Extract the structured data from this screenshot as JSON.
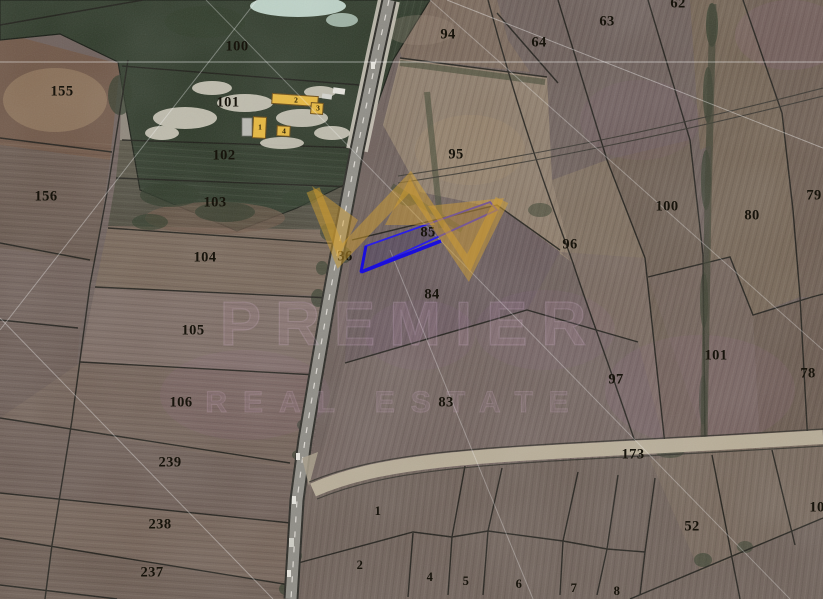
{
  "map": {
    "highlighted_parcel": {
      "label": "85",
      "outline_color": "#2b1fe8"
    },
    "watermark": {
      "line1": "PREMIER",
      "line2": "REAL ESTATE",
      "crown_color": "#d4a031"
    },
    "colors": {
      "field_base": "#6e605b",
      "forest": "#2f3a2a",
      "road": "#8f8d86",
      "dirt_road": "#b8ad97",
      "building": "#e9b93d"
    }
  },
  "parcels": [
    {
      "label": "100",
      "x": 237,
      "y": 47
    },
    {
      "label": "155",
      "x": 62,
      "y": 92
    },
    {
      "label": "101",
      "x": 228,
      "y": 103
    },
    {
      "label": "102",
      "x": 224,
      "y": 156
    },
    {
      "label": "156",
      "x": 46,
      "y": 197
    },
    {
      "label": "103",
      "x": 215,
      "y": 203
    },
    {
      "label": "104",
      "x": 205,
      "y": 258
    },
    {
      "label": "105",
      "x": 193,
      "y": 331
    },
    {
      "label": "106",
      "x": 181,
      "y": 403
    },
    {
      "label": "239",
      "x": 170,
      "y": 463
    },
    {
      "label": "238",
      "x": 160,
      "y": 525
    },
    {
      "label": "237",
      "x": 152,
      "y": 573
    },
    {
      "label": "94",
      "x": 448,
      "y": 35
    },
    {
      "label": "64",
      "x": 539,
      "y": 43
    },
    {
      "label": "63",
      "x": 607,
      "y": 22
    },
    {
      "label": "62",
      "x": 678,
      "y": 4
    },
    {
      "label": "95",
      "x": 456,
      "y": 155
    },
    {
      "label": "85",
      "x": 428,
      "y": 233
    },
    {
      "label": "36",
      "x": 345,
      "y": 257
    },
    {
      "label": "96",
      "x": 570,
      "y": 245
    },
    {
      "label": "84",
      "x": 432,
      "y": 295
    },
    {
      "label": "83",
      "x": 446,
      "y": 403
    },
    {
      "label": "97",
      "x": 616,
      "y": 380
    },
    {
      "label": "100",
      "x": 667,
      "y": 207
    },
    {
      "label": "80",
      "x": 752,
      "y": 216
    },
    {
      "label": "79",
      "x": 814,
      "y": 196
    },
    {
      "label": "101",
      "x": 716,
      "y": 356
    },
    {
      "label": "78",
      "x": 808,
      "y": 374
    },
    {
      "label": "173",
      "x": 633,
      "y": 455
    },
    {
      "label": "1",
      "x": 378,
      "y": 512,
      "small": true
    },
    {
      "label": "52",
      "x": 692,
      "y": 527
    },
    {
      "label": "10",
      "x": 817,
      "y": 508
    },
    {
      "label": "2",
      "x": 360,
      "y": 566,
      "small": true
    },
    {
      "label": "4",
      "x": 430,
      "y": 578,
      "small": true
    },
    {
      "label": "5",
      "x": 466,
      "y": 582,
      "small": true
    },
    {
      "label": "6",
      "x": 519,
      "y": 585,
      "small": true
    },
    {
      "label": "7",
      "x": 574,
      "y": 589,
      "small": true
    },
    {
      "label": "8",
      "x": 617,
      "y": 592,
      "small": true
    }
  ],
  "building_labels": [
    {
      "label": "2",
      "x": 296,
      "y": 101
    },
    {
      "label": "3",
      "x": 318,
      "y": 109
    },
    {
      "label": "1",
      "x": 260,
      "y": 128
    },
    {
      "label": "4",
      "x": 284,
      "y": 132
    }
  ]
}
